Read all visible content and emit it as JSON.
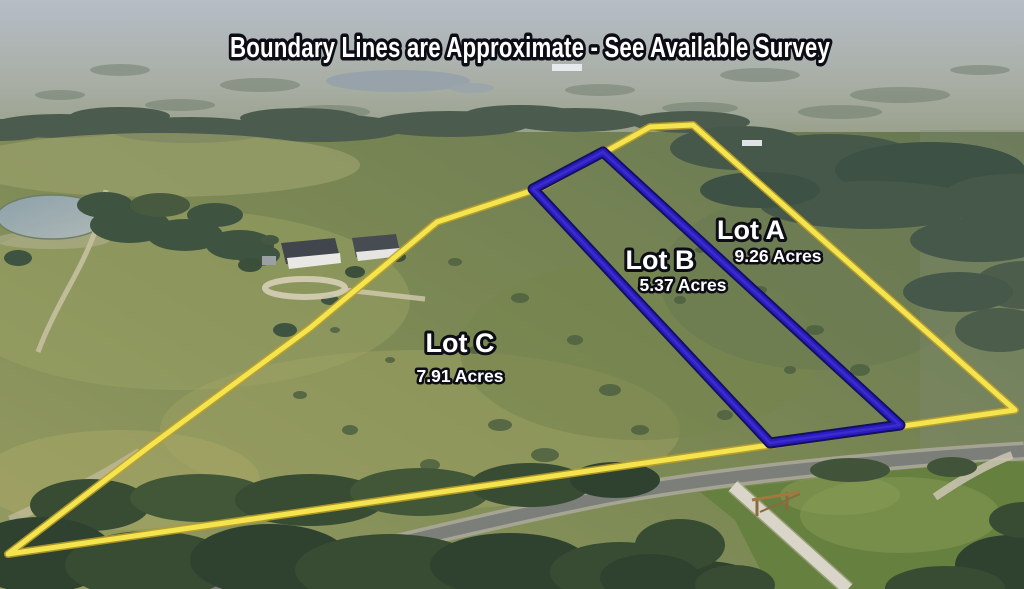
{
  "title": "Boundary Lines are Approximate - See Available Survey",
  "lots": [
    {
      "name": "Lot A",
      "acres": "9.26 Acres"
    },
    {
      "name": "Lot B",
      "acres": "5.37 Acres"
    },
    {
      "name": "Lot C",
      "acres": "7.91 Acres"
    }
  ],
  "colors": {
    "outer_boundary": "#f4e44e",
    "outer_boundary_edge": "#bfa028",
    "inner_boundary": "#2a1cc0",
    "inner_boundary_edge": "#141060",
    "label_fill": "#ffffff",
    "label_outline": "#0d0d16"
  }
}
